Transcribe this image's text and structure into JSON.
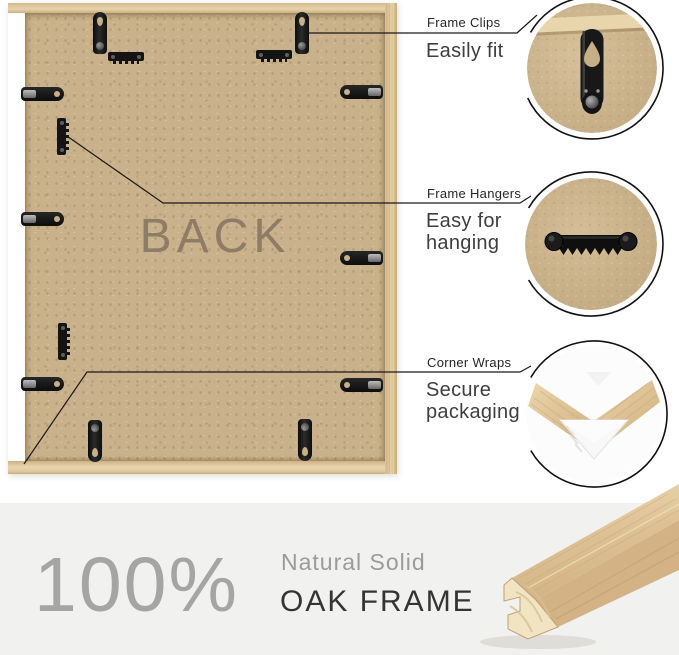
{
  "colors": {
    "background": "#ffffff",
    "band_background": "#f1f1ef",
    "oak_wood": "#dfc89e",
    "mdf_back": "#c9b28b",
    "hardware_black": "#161616",
    "leader_line": "#1a1a1a",
    "back_text": "#8d7d66",
    "muted_gray": "#a5a5a4",
    "dark_text": "#343434"
  },
  "frame": {
    "back_label": "BACK",
    "hardware": [
      {
        "type": "clip-v",
        "name": "frame-clip",
        "x": 93,
        "y": 12
      },
      {
        "type": "clip-v",
        "name": "frame-clip",
        "x": 295,
        "y": 12
      },
      {
        "type": "saw-h",
        "name": "sawtooth-hanger",
        "x": 108,
        "y": 52
      },
      {
        "type": "saw-h",
        "name": "sawtooth-hanger",
        "x": 256,
        "y": 50
      },
      {
        "type": "clip-h",
        "name": "frame-clip",
        "x": 21,
        "y": 87
      },
      {
        "type": "clip-h",
        "name": "frame-clip",
        "x": 21,
        "y": 212
      },
      {
        "type": "clip-h",
        "name": "frame-clip",
        "x": 21,
        "y": 377
      },
      {
        "type": "saw-v",
        "name": "sawtooth-hanger",
        "x": 57,
        "y": 118
      },
      {
        "type": "saw-v",
        "name": "sawtooth-hanger",
        "x": 58,
        "y": 323
      },
      {
        "type": "clip-h",
        "name": "frame-clip",
        "x": 340,
        "y": 85,
        "flip": true
      },
      {
        "type": "clip-h",
        "name": "frame-clip",
        "x": 340,
        "y": 251,
        "flip": true
      },
      {
        "type": "clip-h",
        "name": "frame-clip",
        "x": 340,
        "y": 378,
        "flip": true
      },
      {
        "type": "clip-v",
        "name": "frame-clip",
        "x": 88,
        "y": 420,
        "flip": true
      },
      {
        "type": "clip-v",
        "name": "frame-clip",
        "x": 298,
        "y": 419,
        "flip": true
      }
    ]
  },
  "callouts": [
    {
      "title": "Frame Clips",
      "subtitle": "Easily fit"
    },
    {
      "title": "Frame Hangers",
      "subtitle": "Easy for hanging"
    },
    {
      "title": "Corner Wraps",
      "subtitle": "Secure packaging"
    }
  ],
  "banner": {
    "percent": "100%",
    "subtitle_top": "Natural Solid",
    "subtitle_bottom": "OAK FRAME"
  }
}
